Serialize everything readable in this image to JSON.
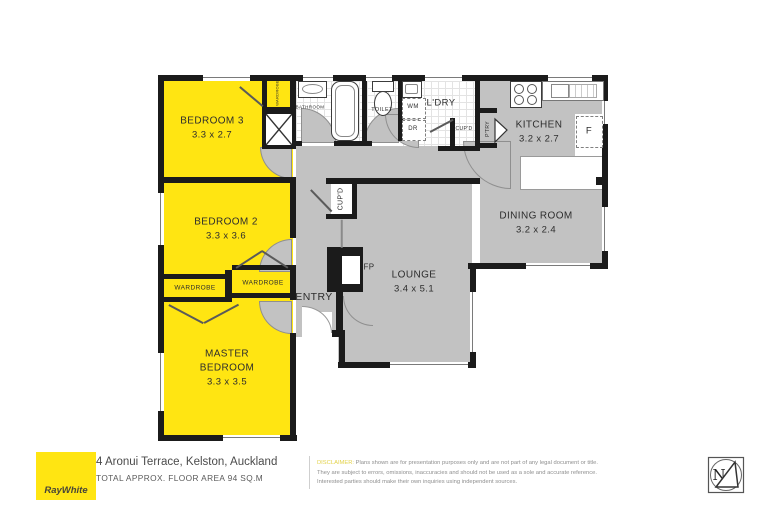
{
  "footer": {
    "brand": "RayWhite",
    "address": "4 Aronui Terrace, Kelston, Auckland",
    "area": "TOTAL APPROX. FLOOR AREA 94 SQ.M",
    "disclaimer_label": "DISCLAIMER:",
    "disclaimer_line1": " Plans shown are for presentation purposes only and are not part of any legal document or title.",
    "disclaimer_line2": "They are subject to errors, omissions, inaccuracies and should not be used as a sole and accurate reference.",
    "disclaimer_line3": "Interested parties should make their own inquiries using independent sources.",
    "compass_n": "N"
  },
  "rooms": {
    "bedroom3": {
      "name": "BEDROOM 3",
      "dims": "3.3 x 2.7"
    },
    "bedroom2": {
      "name": "BEDROOM 2",
      "dims": "3.3 x 3.6"
    },
    "master": {
      "line1": "MASTER",
      "line2": "BEDROOM",
      "dims": "3.3 x 3.5"
    },
    "kitchen": {
      "name": "KITCHEN",
      "dims": "3.2 x 2.7"
    },
    "dining": {
      "name": "DINING ROOM",
      "dims": "3.2 x 2.4"
    },
    "lounge": {
      "name": "LOUNGE",
      "dims": "3.4 x 5.1"
    },
    "entry": {
      "name": "ENTRY"
    },
    "bathroom": {
      "name": "BATHROOM"
    },
    "toilet": {
      "name": "TOILET"
    },
    "laundry": {
      "name": "L'DRY"
    }
  },
  "labels": {
    "wardrobe_left": "WARDROBE",
    "wardrobe_right": "WARDROBE",
    "wardrobe_small": "WARDROBE",
    "hall_cupboard": "CUP'D",
    "laundry_cupboard": "CUP'D",
    "pantry": "P'TRY",
    "washing_machine": "WM",
    "dryer": "DR",
    "fireplace": "FP",
    "fridge": "F"
  },
  "colors": {
    "room_yellow": "#FFE512",
    "floor_gray": "#C2C2C2",
    "wall_black": "#1B1B1B",
    "brand_yellow": "#FFE512",
    "disclaimer_yellow": "#E3D24B"
  }
}
